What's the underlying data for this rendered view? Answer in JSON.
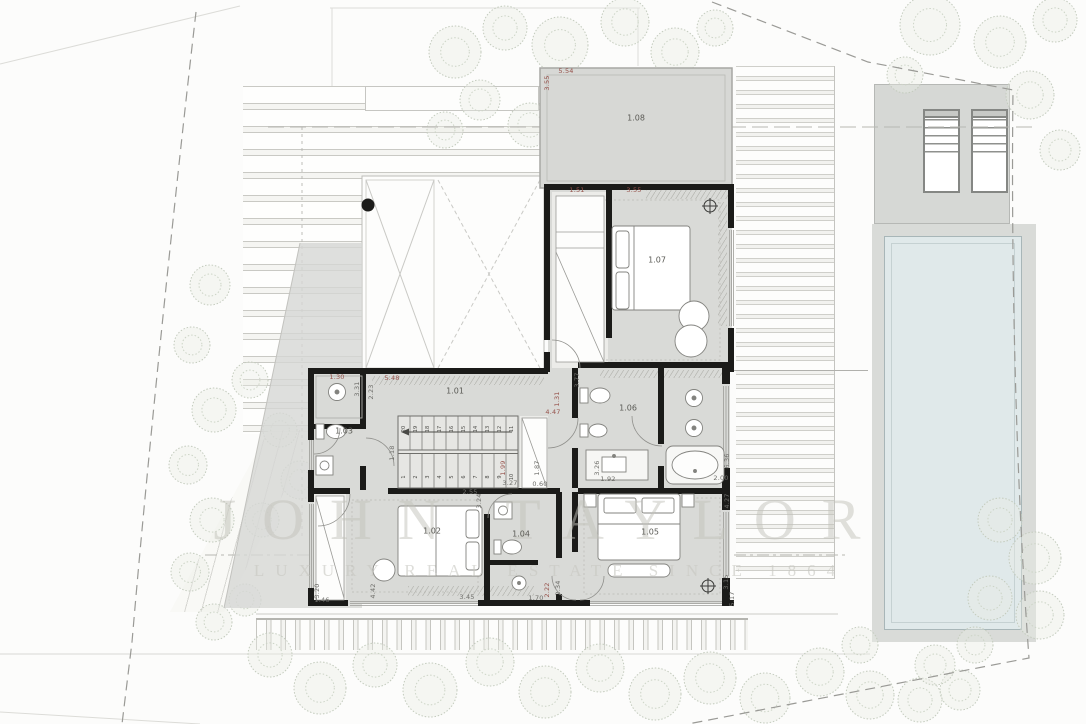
{
  "title": "Villa first floor site plan",
  "watermark": {
    "line1": "JOHN TAYLOR",
    "line2": "LUXURY REAL ESTATE SINCE 1864"
  },
  "rooms": [
    {
      "id": "1.01",
      "x": 455,
      "y": 391
    },
    {
      "id": "1.02",
      "x": 432,
      "y": 531
    },
    {
      "id": "1.03",
      "x": 344,
      "y": 431
    },
    {
      "id": "1.04",
      "x": 521,
      "y": 534
    },
    {
      "id": "1.05",
      "x": 650,
      "y": 532
    },
    {
      "id": "1.06",
      "x": 628,
      "y": 408
    },
    {
      "id": "1.07",
      "x": 657,
      "y": 260
    },
    {
      "id": "1.08",
      "x": 636,
      "y": 118
    }
  ],
  "dims": [
    {
      "t": "5.54",
      "x": 566,
      "y": 71,
      "r": 0,
      "c": "r"
    },
    {
      "t": "3.55",
      "x": 547,
      "y": 83,
      "r": 1,
      "c": "r"
    },
    {
      "t": "1.51",
      "x": 577,
      "y": 190,
      "r": 0,
      "c": "r"
    },
    {
      "t": "3.55",
      "x": 634,
      "y": 190,
      "r": 0,
      "c": "r"
    },
    {
      "t": "1.30",
      "x": 337,
      "y": 377,
      "r": 0,
      "c": "r"
    },
    {
      "t": "3.31",
      "x": 357,
      "y": 389,
      "r": 1,
      "c": "g"
    },
    {
      "t": "2.23",
      "x": 371,
      "y": 392,
      "r": 1,
      "c": "g"
    },
    {
      "t": "5.48",
      "x": 392,
      "y": 378,
      "r": 0,
      "c": "r"
    },
    {
      "t": "1.18",
      "x": 392,
      "y": 453,
      "r": 1,
      "c": "g"
    },
    {
      "t": "1.31",
      "x": 557,
      "y": 399,
      "r": 1,
      "c": "r"
    },
    {
      "t": "4.47",
      "x": 553,
      "y": 412,
      "r": 0,
      "c": "r"
    },
    {
      "t": "1.99",
      "x": 503,
      "y": 468,
      "r": 1,
      "c": "r"
    },
    {
      "t": "3.27",
      "x": 510,
      "y": 483,
      "r": 0,
      "c": "g"
    },
    {
      "t": "1.87",
      "x": 537,
      "y": 468,
      "r": 1,
      "c": "g"
    },
    {
      "t": "0.60",
      "x": 540,
      "y": 484,
      "r": 0,
      "c": "g"
    },
    {
      "t": "2.55",
      "x": 470,
      "y": 492,
      "r": 0,
      "c": "g"
    },
    {
      "t": "3.24",
      "x": 479,
      "y": 501,
      "r": 1,
      "c": "g"
    },
    {
      "t": "3.77",
      "x": 577,
      "y": 380,
      "r": 1,
      "c": "g"
    },
    {
      "t": "3.26",
      "x": 597,
      "y": 468,
      "r": 1,
      "c": "g"
    },
    {
      "t": "1.92",
      "x": 608,
      "y": 479,
      "r": 0,
      "c": "g"
    },
    {
      "t": "2.00",
      "x": 721,
      "y": 478,
      "r": 0,
      "c": "g"
    },
    {
      "t": "6.36",
      "x": 727,
      "y": 461,
      "r": 1,
      "c": "g"
    },
    {
      "t": "4.27",
      "x": 727,
      "y": 501,
      "r": 1,
      "c": "g"
    },
    {
      "t": "3.15",
      "x": 726,
      "y": 582,
      "r": 1,
      "c": "g"
    },
    {
      "t": "5.17",
      "x": 732,
      "y": 599,
      "r": 1,
      "c": "g"
    },
    {
      "t": "3.20",
      "x": 317,
      "y": 591,
      "r": 1,
      "c": "g"
    },
    {
      "t": "1.46",
      "x": 322,
      "y": 600,
      "r": 0,
      "c": "g"
    },
    {
      "t": "4.42",
      "x": 373,
      "y": 591,
      "r": 1,
      "c": "g"
    },
    {
      "t": "3.45",
      "x": 467,
      "y": 597,
      "r": 0,
      "c": "g"
    },
    {
      "t": "1.70",
      "x": 536,
      "y": 598,
      "r": 0,
      "c": "g"
    },
    {
      "t": "2.22",
      "x": 547,
      "y": 590,
      "r": 1,
      "c": "r"
    },
    {
      "t": "2.34",
      "x": 558,
      "y": 588,
      "r": 1,
      "c": "g"
    }
  ],
  "stairs": {
    "lower": [
      "1",
      "2",
      "3",
      "4",
      "5",
      "6",
      "7",
      "8",
      "9",
      "10"
    ],
    "upper": [
      "20",
      "19",
      "18",
      "17",
      "16",
      "15",
      "14",
      "13",
      "12",
      "11"
    ]
  },
  "colors": {
    "wall": "#1b1b19",
    "floor": "#d9dad7",
    "pool_water": "#e0e9ea",
    "dimension_red": "#96524b",
    "dimension_gray": "#6e6e6a",
    "tree_stroke": "#c3cbbd",
    "watermark": "#c1c1ba"
  }
}
